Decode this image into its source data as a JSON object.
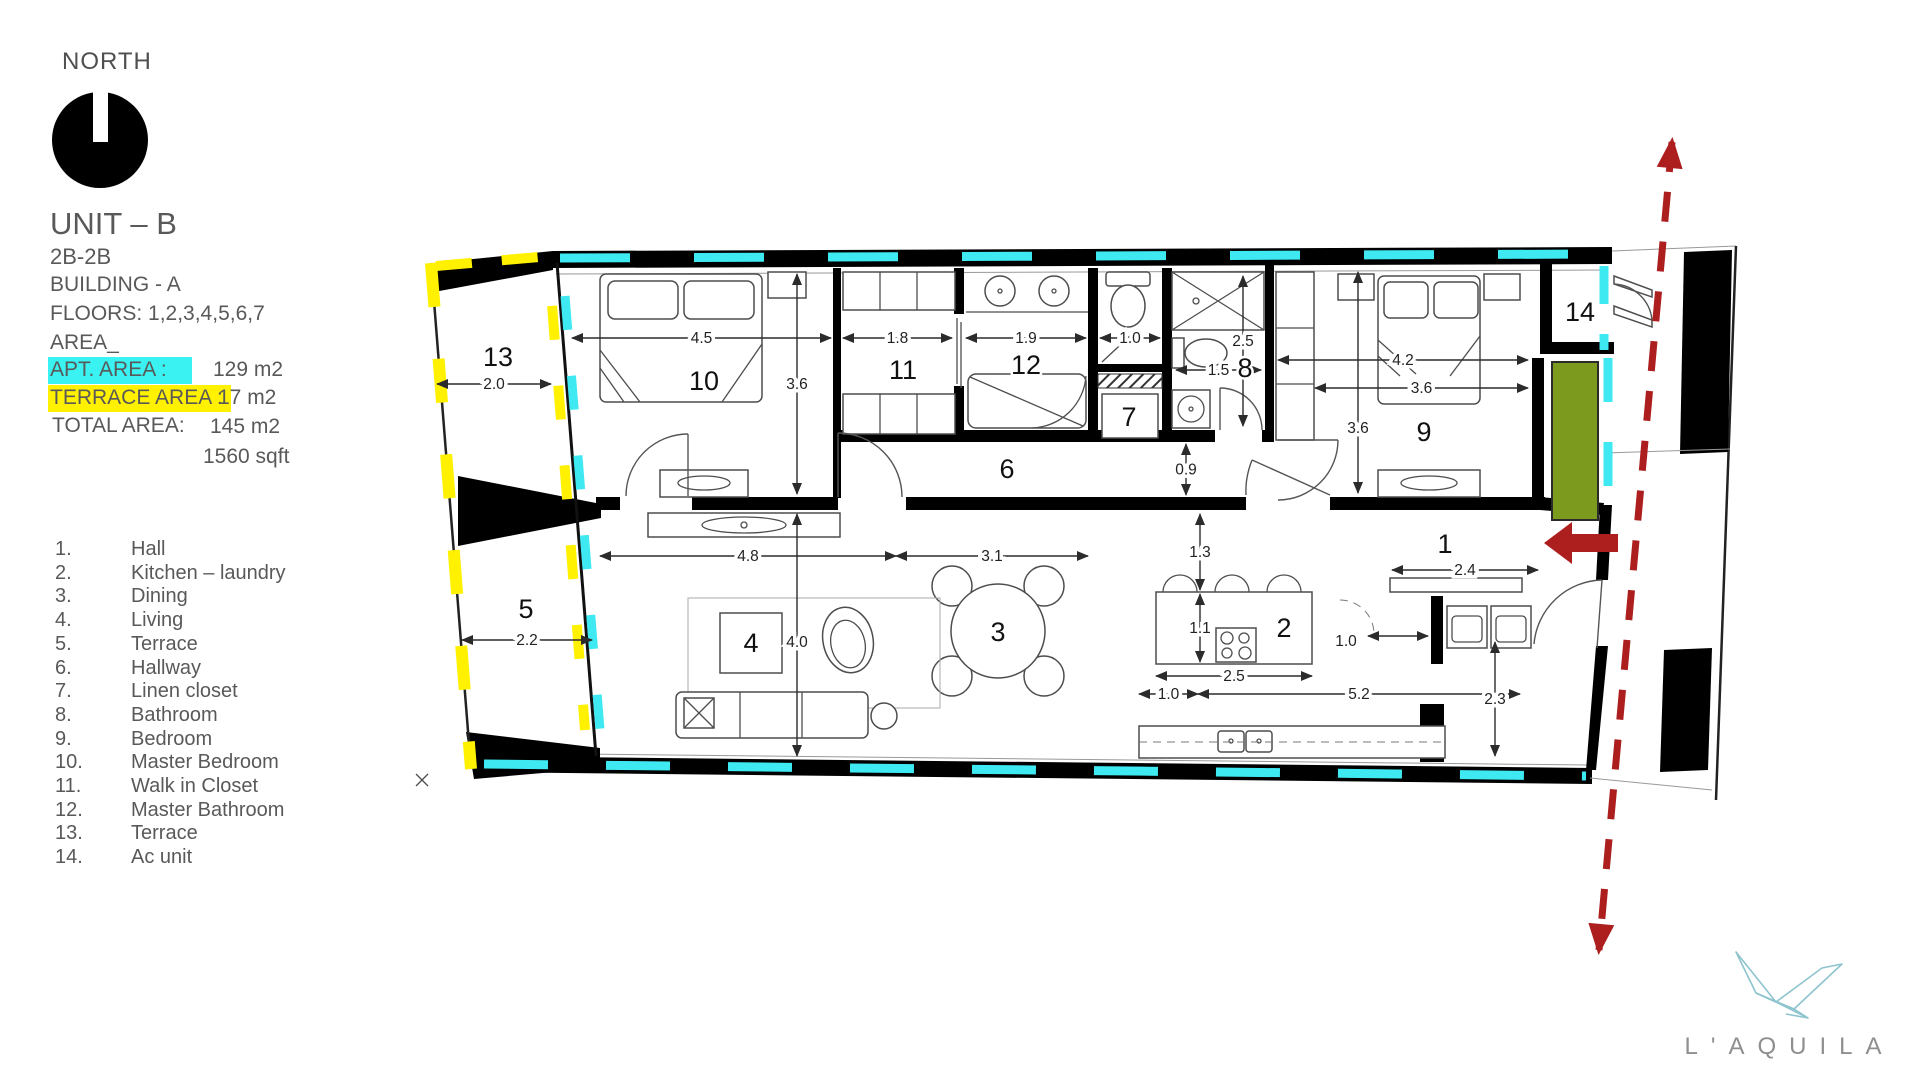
{
  "info": {
    "north_label": "NORTH",
    "unit_title": "UNIT – B",
    "unit_config": "2B-2B",
    "building": "BUILDING - A",
    "floors": "FLOORS: 1,2,3,4,5,6,7",
    "area_heading": "AREA_",
    "apt_area_label": "APT. AREA :",
    "apt_area_value": "129 m2",
    "terrace_area_label": "TERRACE AREA :",
    "terrace_area_value": "17 m2",
    "total_area_label": "TOTAL AREA:",
    "total_area_value": "145 m2",
    "total_area_sqft": "1560 sqft"
  },
  "legend": [
    {
      "num": "1.",
      "name": "Hall"
    },
    {
      "num": "2.",
      "name": "Kitchen – laundry"
    },
    {
      "num": "3.",
      "name": "Dining"
    },
    {
      "num": "4.",
      "name": "Living"
    },
    {
      "num": "5.",
      "name": "Terrace"
    },
    {
      "num": "6.",
      "name": "Hallway"
    },
    {
      "num": "7.",
      "name": "Linen closet"
    },
    {
      "num": "8.",
      "name": "Bathroom"
    },
    {
      "num": "9.",
      "name": "Bedroom"
    },
    {
      "num": "10.",
      "name": "Master Bedroom"
    },
    {
      "num": "11.",
      "name": "Walk in Closet"
    },
    {
      "num": "12.",
      "name": "Master Bathroom"
    },
    {
      "num": "13.",
      "name": "Terrace"
    },
    {
      "num": "14.",
      "name": "Ac unit"
    }
  ],
  "plan": {
    "rooms": [
      {
        "id": "1",
        "x": 1445,
        "y": 553
      },
      {
        "id": "2",
        "x": 1284,
        "y": 637
      },
      {
        "id": "3",
        "x": 998,
        "y": 641
      },
      {
        "id": "4",
        "x": 751,
        "y": 652
      },
      {
        "id": "5",
        "x": 526,
        "y": 618
      },
      {
        "id": "6",
        "x": 1007,
        "y": 478
      },
      {
        "id": "7",
        "x": 1129,
        "y": 426
      },
      {
        "id": "8",
        "x": 1245,
        "y": 377
      },
      {
        "id": "9",
        "x": 1424,
        "y": 441
      },
      {
        "id": "10",
        "x": 704,
        "y": 390
      },
      {
        "id": "11",
        "x": 903,
        "y": 379
      },
      {
        "id": "12",
        "x": 1026,
        "y": 374
      },
      {
        "id": "13",
        "x": 498,
        "y": 366
      },
      {
        "id": "14",
        "x": 1580,
        "y": 321
      }
    ],
    "dimensions": [
      {
        "v": "2.0",
        "x1": 437,
        "y1": 384,
        "x2": 551,
        "y2": 384
      },
      {
        "v": "4.5",
        "x1": 572,
        "y1": 338,
        "x2": 831,
        "y2": 338
      },
      {
        "v": "3.6",
        "x1": 797,
        "y1": 274,
        "x2": 797,
        "y2": 494
      },
      {
        "v": "1.8",
        "x1": 843,
        "y1": 338,
        "x2": 952,
        "y2": 338
      },
      {
        "v": "1.9",
        "x1": 966,
        "y1": 338,
        "x2": 1086,
        "y2": 338
      },
      {
        "v": "1.0",
        "x1": 1100,
        "y1": 338,
        "x2": 1160,
        "y2": 338
      },
      {
        "v": "2.5",
        "x1": 1243,
        "y1": 276,
        "x2": 1243,
        "y2": 426,
        "ly": 341
      },
      {
        "v": "1.5",
        "x1": 1176,
        "y1": 370,
        "x2": 1261,
        "y2": 370
      },
      {
        "v": "4.2",
        "x1": 1278,
        "y1": 360,
        "x2": 1528,
        "y2": 360
      },
      {
        "v": "3.6",
        "x1": 1315,
        "y1": 388,
        "x2": 1528,
        "y2": 388
      },
      {
        "v": "3.6",
        "x1": 1358,
        "y1": 272,
        "x2": 1358,
        "y2": 493,
        "ly": 428
      },
      {
        "v": "0.9",
        "x1": 1186,
        "y1": 444,
        "x2": 1186,
        "y2": 495
      },
      {
        "v": "4.8",
        "x1": 600,
        "y1": 556,
        "x2": 896,
        "y2": 556
      },
      {
        "v": "3.1",
        "x1": 896,
        "y1": 556,
        "x2": 1088,
        "y2": 556
      },
      {
        "v": "4.0",
        "x1": 797,
        "y1": 514,
        "x2": 797,
        "y2": 756,
        "ly": 642
      },
      {
        "v": "2.2",
        "x1": 462,
        "y1": 640,
        "x2": 592,
        "y2": 640
      },
      {
        "v": "1.3",
        "x1": 1200,
        "y1": 514,
        "x2": 1200,
        "y2": 590
      },
      {
        "v": "1.1",
        "x1": 1200,
        "y1": 594,
        "x2": 1200,
        "y2": 662
      },
      {
        "v": "2.5",
        "x1": 1156,
        "y1": 676,
        "x2": 1312,
        "y2": 676
      },
      {
        "v": "1.0",
        "x1": 1139,
        "y1": 694,
        "x2": 1198,
        "y2": 694
      },
      {
        "v": "5.2",
        "x1": 1198,
        "y1": 694,
        "x2": 1520,
        "y2": 694
      },
      {
        "v": "2.3",
        "x1": 1495,
        "y1": 642,
        "x2": 1495,
        "y2": 756
      },
      {
        "v": "1.0",
        "x1": 1368,
        "y1": 636,
        "x2": 1428,
        "y2": 636,
        "lx": 1346,
        "ly": 641
      },
      {
        "v": "2.4",
        "x1": 1392,
        "y1": 570,
        "x2": 1538,
        "y2": 570
      }
    ]
  },
  "brand": {
    "name": "L'AQUILA"
  },
  "colors": {
    "accent_cyan": "#3AF2F2",
    "accent_yellow": "#FFF100",
    "plan_cyan": "#3FE9F2",
    "plan_yellow": "#FFF100",
    "arrow_red": "#AD1F1F",
    "planter_green": "#7C9B1E",
    "text_gray": "#595959"
  }
}
